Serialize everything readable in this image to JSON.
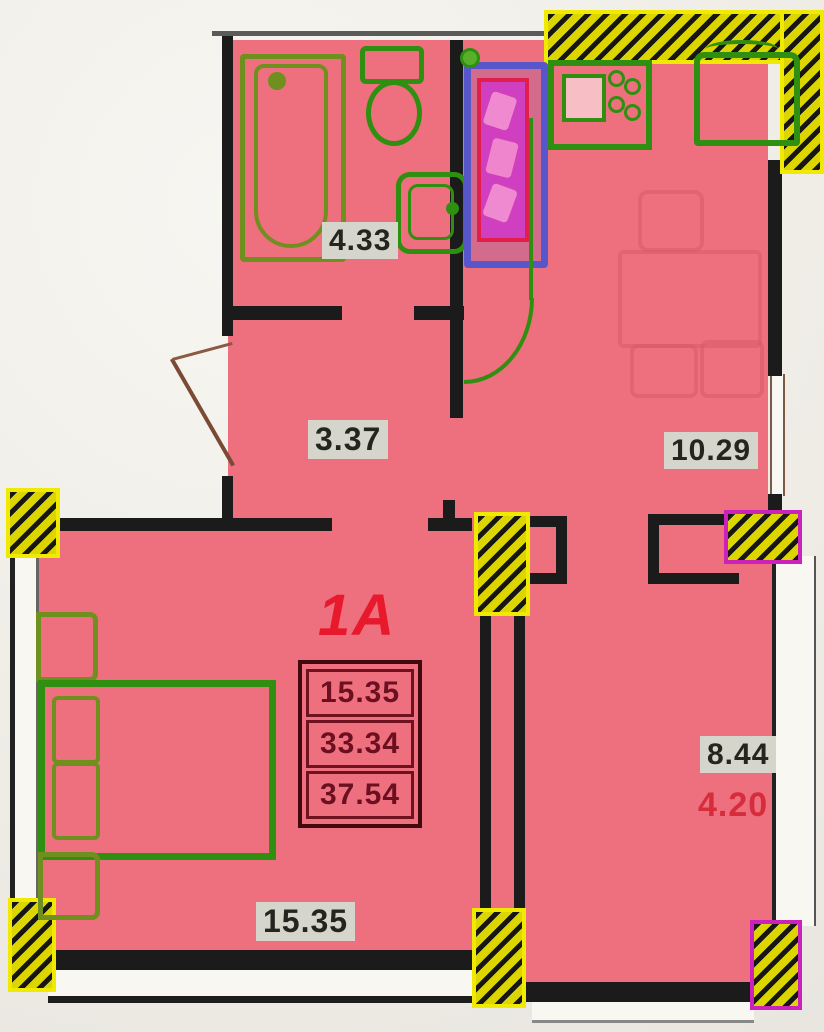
{
  "plan": {
    "unit_label": "1A",
    "area_table": {
      "rows": [
        "15.35",
        "33.34",
        "37.54"
      ]
    },
    "rooms": {
      "bathroom": {
        "area": "4.33"
      },
      "hallway": {
        "area": "3.37"
      },
      "kitchen": {
        "area": "10.29"
      },
      "living_room": {
        "area": "15.35"
      },
      "balcony": {
        "area": "8.44",
        "area_reduced": "4.20"
      }
    },
    "colors": {
      "floor": "#ee6f7e",
      "wall": "#1b1b1b",
      "hatch_yellow": "#ddd500",
      "hatch_outline": "#f0ea00",
      "hatch_magenta": "#cc22bb",
      "fixture_green": "#2f8f10",
      "fixture_olive": "#6f8f1f",
      "unit_red": "#e8192c",
      "closet_purple": "#5757cb",
      "closet_magenta": "#cf3fc0",
      "chip_bg": "#d6d5cc",
      "chip_text": "#25251f",
      "table_text": "#6b1020"
    }
  }
}
